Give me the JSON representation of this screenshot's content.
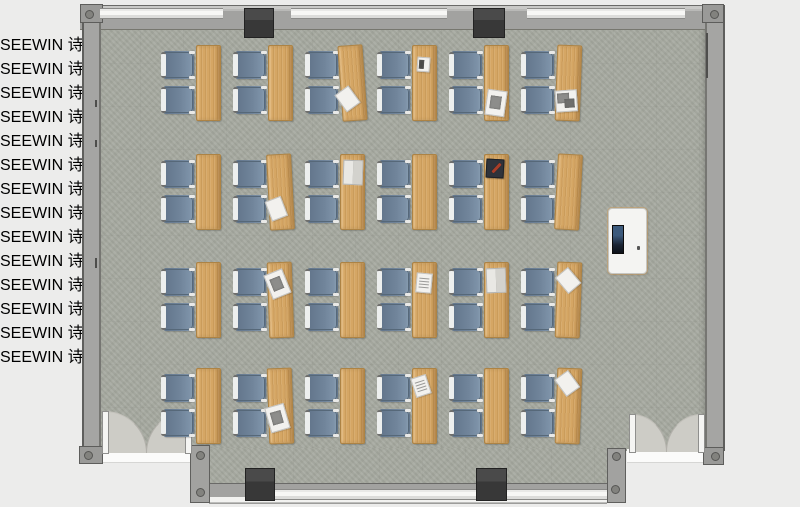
{
  "title": "Classroom furniture floor plan (top view)",
  "watermark": {
    "text": "SEEWIN 诗敏",
    "bands": [
      {
        "y": 308,
        "xs": [
          28,
          130,
          270,
          373,
          505,
          620,
          737
        ]
      },
      {
        "y": 356,
        "xs": [
          -12,
          108,
          230,
          327,
          460,
          570,
          693
        ]
      }
    ]
  },
  "palette": {
    "background": "#ececeb",
    "floor": "#a6a9a0",
    "wall": "#9c9c9a",
    "wall_outline": "#5f5f5d",
    "window": "#f7f7f5",
    "pillar": "#3f3f3f",
    "desk_wood": "#d5a664",
    "chair_seat": "#70849a",
    "chair_frame": "#edefee",
    "teacher_desk": "#f4f4f2",
    "monitor_screen": "#3c5a7c",
    "door_swing": "#cdccc6"
  },
  "grid": {
    "rows_y": [
      45,
      154,
      262,
      368
    ],
    "cols_x": [
      196,
      268,
      340,
      412,
      484,
      556
    ],
    "desk_w": 23,
    "desk_h": 74,
    "chair_w": 29,
    "chair_h": 26,
    "chair_dx": -33,
    "chair_dys": [
      6,
      41
    ],
    "rows": 4,
    "cols": 6,
    "seats_per_desk": 2
  },
  "desk_rotations": {
    "1-3": -4,
    "1-6": 2,
    "2-2": -3,
    "2-6": 3,
    "3-2": -2,
    "3-6": 2,
    "4-2": -2,
    "4-6": 2
  },
  "desk_items": [
    {
      "row": 1,
      "col": 3,
      "type": "paper",
      "dx": -3,
      "dy": 42,
      "rot": -32
    },
    {
      "row": 1,
      "col": 4,
      "type": "note_dark",
      "dx": 4,
      "dy": 11,
      "rot": 4
    },
    {
      "row": 1,
      "col": 5,
      "type": "paper_photo",
      "dx": 1,
      "dy": 44,
      "rot": 8
    },
    {
      "row": 1,
      "col": 6,
      "type": "photo_stack",
      "dx": -1,
      "dy": 44,
      "rot": -6
    },
    {
      "row": 2,
      "col": 2,
      "type": "paper",
      "dx": -2,
      "dy": 43,
      "rot": -18
    },
    {
      "row": 2,
      "col": 3,
      "type": "book_open",
      "dx": 2,
      "dy": 5,
      "rot": 2
    },
    {
      "row": 2,
      "col": 5,
      "type": "book_dark",
      "dx": 1,
      "dy": 4,
      "rot": 3
    },
    {
      "row": 3,
      "col": 2,
      "type": "paper_photo",
      "dx": -1,
      "dy": 8,
      "rot": -20
    },
    {
      "row": 3,
      "col": 4,
      "type": "paper_lines",
      "dx": 3,
      "dy": 10,
      "rot": 5
    },
    {
      "row": 3,
      "col": 5,
      "type": "book_open",
      "dx": 1,
      "dy": 5,
      "rot": -2
    },
    {
      "row": 3,
      "col": 6,
      "type": "paper",
      "dx": 2,
      "dy": 7,
      "rot": -42
    },
    {
      "row": 4,
      "col": 2,
      "type": "paper_photo",
      "dx": -2,
      "dy": 36,
      "rot": -14
    },
    {
      "row": 4,
      "col": 4,
      "type": "paper_lines",
      "dx": 0,
      "dy": 7,
      "rot": -18
    },
    {
      "row": 4,
      "col": 6,
      "type": "paper",
      "dx": 1,
      "dy": 4,
      "rot": -38
    }
  ],
  "teacher_station": {
    "desk": {
      "x": 608,
      "y": 208,
      "w": 37,
      "h": 64
    },
    "monitor": {
      "x": 612,
      "y": 225,
      "w": 10,
      "h": 27
    },
    "cpu": {
      "x": 610,
      "y": 256,
      "w": 9,
      "h": 11
    },
    "mouse": {
      "x": 637,
      "y": 246,
      "w": 3,
      "h": 4
    },
    "chair": {
      "x": 649,
      "y": 227,
      "w": 27,
      "h": 31
    },
    "casters": [
      [
        -2,
        -3
      ],
      [
        24,
        -3
      ],
      [
        -2,
        29
      ],
      [
        24,
        29
      ],
      [
        -5,
        13
      ]
    ]
  },
  "structure": {
    "top_windows": [
      {
        "x": 100,
        "w": 123
      },
      {
        "x": 291,
        "w": 156
      },
      {
        "x": 527,
        "w": 158
      }
    ],
    "bottom_windows": [
      {
        "x": 273,
        "w": 203
      },
      {
        "x": 505,
        "w": 102
      }
    ],
    "top_pillars": [
      {
        "x": 244,
        "y": 8,
        "w": 28,
        "h": 28
      },
      {
        "x": 473,
        "y": 8,
        "w": 30,
        "h": 28
      }
    ],
    "bottom_pillars": [
      {
        "x": 245,
        "y": 468,
        "w": 28,
        "h": 31
      },
      {
        "x": 476,
        "y": 468,
        "w": 29,
        "h": 31
      }
    ],
    "corner_dots": [
      [
        85,
        10
      ],
      [
        710,
        10
      ],
      [
        84,
        451
      ],
      [
        711,
        452
      ],
      [
        196,
        451
      ],
      [
        196,
        488
      ],
      [
        612,
        452
      ],
      [
        611,
        485
      ]
    ],
    "doors": [
      {
        "side": "left",
        "x": 102,
        "y": 411,
        "w": 88,
        "h": 41
      },
      {
        "side": "right",
        "x": 629,
        "y": 414,
        "w": 74,
        "h": 37
      }
    ]
  }
}
